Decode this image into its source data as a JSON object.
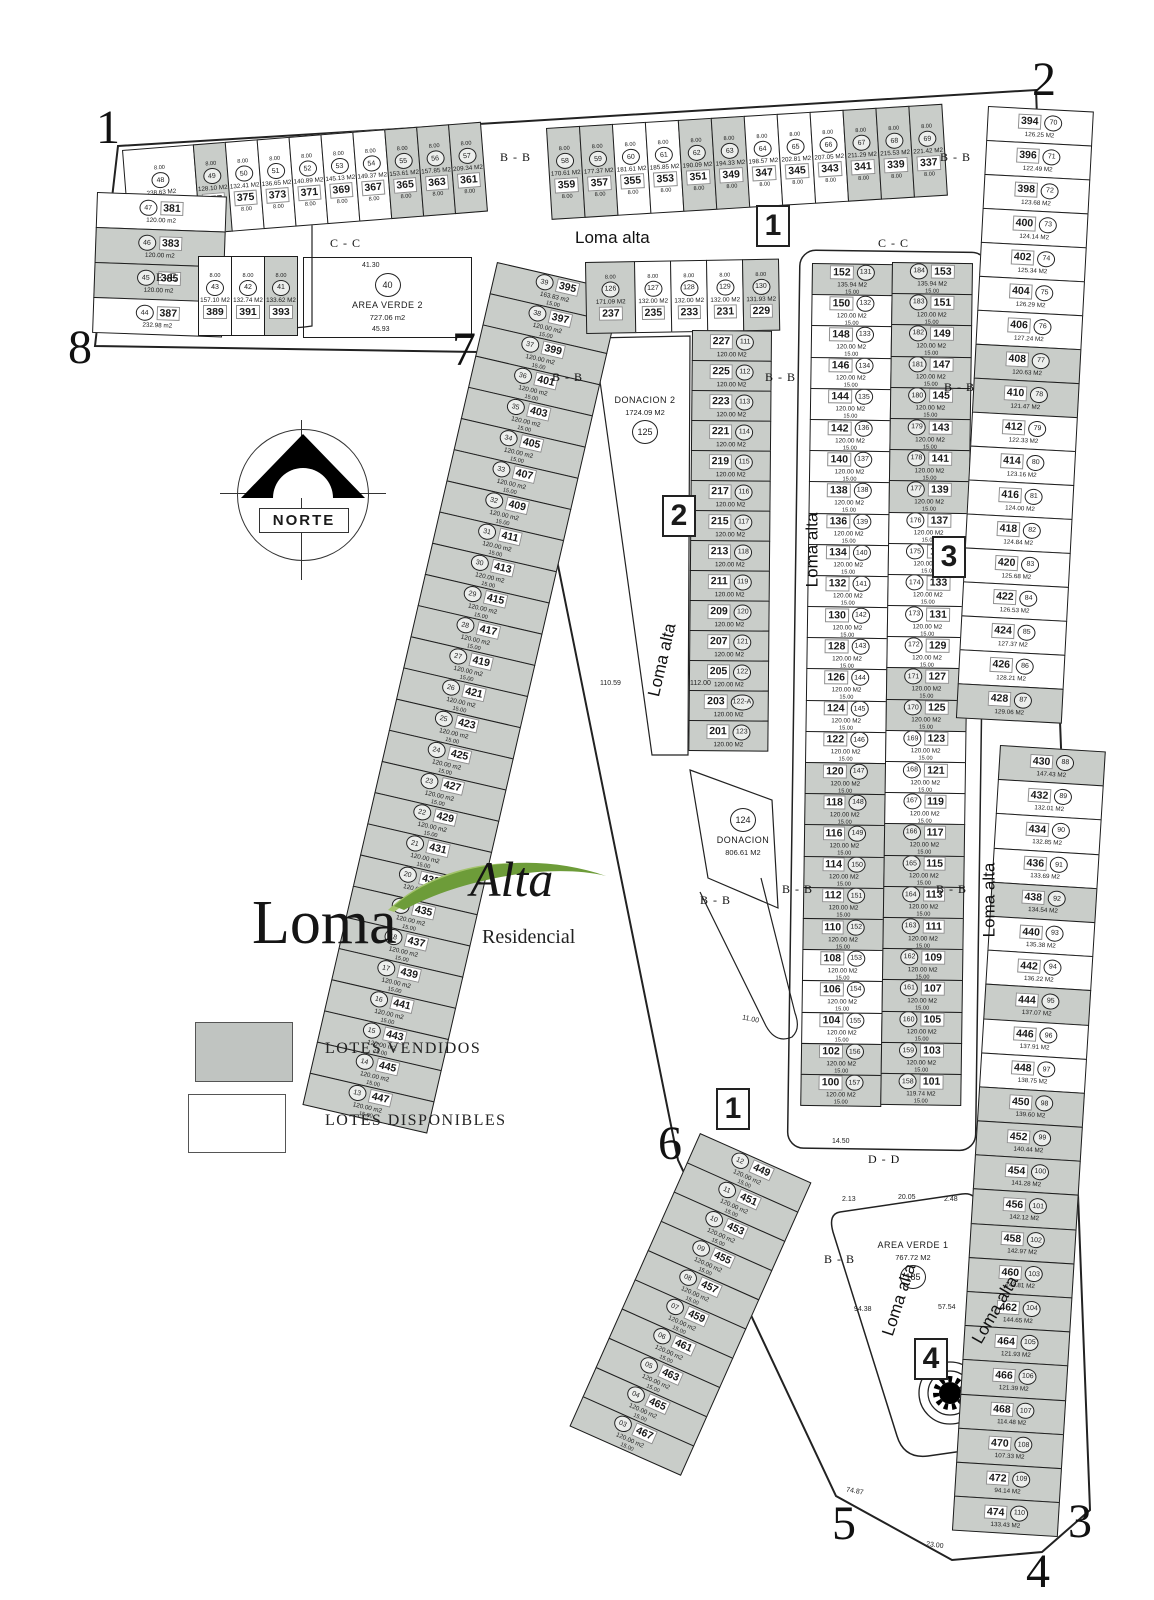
{
  "legend": {
    "sold_label": "LOTES VENDIDOS",
    "available_label": "LOTES DISPONIBLES"
  },
  "logo": {
    "word_main": "Loma",
    "word_accent": "Alta",
    "word_sub": "Residencial"
  },
  "compass": {
    "label": "NORTE"
  },
  "streets": {
    "name": "Loma alta"
  },
  "sections": {
    "cc": "C - C",
    "bb": "B - B",
    "dd": "D - D",
    "ee": "E-E"
  },
  "corner_markers": [
    "1",
    "2",
    "3",
    "4",
    "5",
    "6",
    "7",
    "8"
  ],
  "route_markers": [
    "1",
    "2",
    "3",
    "1",
    "4"
  ],
  "green_areas": {
    "area_verde_2": {
      "name": "AREA VERDE 2",
      "area": "727.06 m2",
      "ref": "40"
    },
    "donacion_2": {
      "name": "DONACION 2",
      "area": "1724.09 M2",
      "ref": "125"
    },
    "donacion_1": {
      "name": "DONACION",
      "area": "806.61 M2",
      "ref": "124"
    },
    "area_verde_1": {
      "name": "AREA VERDE 1",
      "area": "767.72 M2",
      "ref": "185"
    }
  },
  "dimensions": [
    "41.30",
    "45.93",
    "110.59",
    "112.00",
    "11.00",
    "74.87",
    "23.00",
    "2.13",
    "20.05",
    "2.48",
    "94.38",
    "57.54",
    "14.50"
  ],
  "colors": {
    "sold_fill": "#c9cdc9",
    "line": "#1c1c1c",
    "logo_green_dark": "#6d9c39",
    "logo_green_light": "#a3c36b"
  },
  "blocks": {
    "top_left_row": [
      {
        "l": "379",
        "r": "48",
        "a": "238.63 M2",
        "s": false
      },
      {
        "l": "377",
        "r": "49",
        "a": "128.10 M2",
        "s": true
      },
      {
        "l": "375",
        "r": "50",
        "a": "132.41 M2",
        "s": false
      },
      {
        "l": "373",
        "r": "51",
        "a": "136.65 M2",
        "s": false
      },
      {
        "l": "371",
        "r": "52",
        "a": "140.89 M2",
        "s": false
      },
      {
        "l": "369",
        "r": "53",
        "a": "145.13 M2",
        "s": false
      },
      {
        "l": "367",
        "r": "54",
        "a": "149.37 M2",
        "s": false
      },
      {
        "l": "365",
        "r": "55",
        "a": "153.61 M2",
        "s": true
      },
      {
        "l": "363",
        "r": "56",
        "a": "157.85 M2",
        "s": true
      },
      {
        "l": "361",
        "r": "57",
        "a": "209.34 M2",
        "s": true
      }
    ],
    "top_right_row": [
      {
        "l": "359",
        "r": "58",
        "a": "170.61 M2",
        "s": true
      },
      {
        "l": "357",
        "r": "59",
        "a": "177.37 M2",
        "s": true
      },
      {
        "l": "355",
        "r": "60",
        "a": "181.61 M2",
        "s": false
      },
      {
        "l": "353",
        "r": "61",
        "a": "185.85 M2",
        "s": false
      },
      {
        "l": "351",
        "r": "62",
        "a": "190.09 M2",
        "s": true
      },
      {
        "l": "349",
        "r": "63",
        "a": "194.33 M2",
        "s": true
      },
      {
        "l": "347",
        "r": "64",
        "a": "198.57 M2",
        "s": false
      },
      {
        "l": "345",
        "r": "65",
        "a": "202.81 M2",
        "s": false
      },
      {
        "l": "343",
        "r": "66",
        "a": "207.05 M2",
        "s": false
      },
      {
        "l": "341",
        "r": "67",
        "a": "211.29 M2",
        "s": true
      },
      {
        "l": "339",
        "r": "68",
        "a": "215.53 M2",
        "s": true
      },
      {
        "l": "337",
        "r": "69",
        "a": "221.42 M2",
        "s": true
      }
    ],
    "left_edge": [
      {
        "l": "381",
        "r": "47",
        "a": "120.00 m2",
        "s": false
      },
      {
        "l": "383",
        "r": "46",
        "a": "120.00 m2",
        "s": true
      },
      {
        "l": "385",
        "r": "45",
        "a": "120.00 m2",
        "s": true
      },
      {
        "l": "387",
        "r": "44",
        "a": "232.98 m2",
        "s": false
      }
    ],
    "row2": [
      {
        "l": "389",
        "r": "43",
        "a": "157.10 M2",
        "s": false
      },
      {
        "l": "391",
        "r": "42",
        "a": "132.74 M2",
        "s": false
      },
      {
        "l": "393",
        "r": "41",
        "a": "133.62 M2",
        "s": true
      }
    ],
    "west_diag_a": [
      {
        "l": "395",
        "r": "39",
        "a": "163.83 m2",
        "s": true
      },
      {
        "l": "397",
        "r": "38",
        "a": "120.00 m2",
        "s": true
      },
      {
        "l": "399",
        "r": "37",
        "a": "120.00 m2",
        "s": true
      },
      {
        "l": "401",
        "r": "36",
        "a": "120.00 m2",
        "s": true
      },
      {
        "l": "403",
        "r": "35",
        "a": "120.00 m2",
        "s": true
      },
      {
        "l": "405",
        "r": "34",
        "a": "120.00 m2",
        "s": true
      },
      {
        "l": "407",
        "r": "33",
        "a": "120.00 m2",
        "s": true
      },
      {
        "l": "409",
        "r": "32",
        "a": "120.00 m2",
        "s": true
      },
      {
        "l": "411",
        "r": "31",
        "a": "120.00 m2",
        "s": true
      },
      {
        "l": "413",
        "r": "30",
        "a": "120.00 m2",
        "s": true
      },
      {
        "l": "415",
        "r": "29",
        "a": "120.00 m2",
        "s": true
      },
      {
        "l": "417",
        "r": "28",
        "a": "120.00 m2",
        "s": true
      },
      {
        "l": "419",
        "r": "27",
        "a": "120.00 m2",
        "s": true
      },
      {
        "l": "421",
        "r": "26",
        "a": "120.00 m2",
        "s": true
      },
      {
        "l": "423",
        "r": "25",
        "a": "120.00 m2",
        "s": true
      },
      {
        "l": "425",
        "r": "24",
        "a": "120.00 m2",
        "s": true
      },
      {
        "l": "427",
        "r": "23",
        "a": "120.00 m2",
        "s": true
      },
      {
        "l": "429",
        "r": "22",
        "a": "120.00 m2",
        "s": true
      },
      {
        "l": "431",
        "r": "21",
        "a": "120.00 m2",
        "s": true
      },
      {
        "l": "433",
        "r": "20",
        "a": "120.00 m2",
        "s": true
      },
      {
        "l": "435",
        "r": "19",
        "a": "120.00 m2",
        "s": true
      },
      {
        "l": "437",
        "r": "18",
        "a": "120.00 m2",
        "s": true
      },
      {
        "l": "439",
        "r": "17",
        "a": "120.00 m2",
        "s": true
      },
      {
        "l": "441",
        "r": "16",
        "a": "120.00 m2",
        "s": true
      },
      {
        "l": "443",
        "r": "15",
        "a": "120.00 m2",
        "s": true
      },
      {
        "l": "445",
        "r": "14",
        "a": "120.00 m2",
        "s": true
      },
      {
        "l": "447",
        "r": "13",
        "a": "120.00 m2",
        "s": true
      }
    ],
    "west_diag_b": [
      {
        "l": "449",
        "r": "12",
        "a": "120.00 m2",
        "s": true
      },
      {
        "l": "451",
        "r": "11",
        "a": "120.00 m2",
        "s": true
      },
      {
        "l": "453",
        "r": "10",
        "a": "120.00 m2",
        "s": true
      },
      {
        "l": "455",
        "r": "09",
        "a": "120.00 m2",
        "s": true
      },
      {
        "l": "457",
        "r": "08",
        "a": "120.00 m2",
        "s": true
      },
      {
        "l": "459",
        "r": "07",
        "a": "120.00 m2",
        "s": true
      },
      {
        "l": "461",
        "r": "06",
        "a": "120.00 m2",
        "s": true
      },
      {
        "l": "463",
        "r": "05",
        "a": "120.00 m2",
        "s": true
      },
      {
        "l": "465",
        "r": "04",
        "a": "120.00 m2",
        "s": true
      },
      {
        "l": "467",
        "r": "03",
        "a": "120.00 m2",
        "s": true
      }
    ],
    "center_top_row": [
      {
        "l": "237",
        "r": "126",
        "a": "171.09 M2",
        "s": true
      },
      {
        "l": "235",
        "r": "127",
        "a": "132.00 M2",
        "s": false
      },
      {
        "l": "233",
        "r": "128",
        "a": "132.00 M2",
        "s": false
      },
      {
        "l": "231",
        "r": "129",
        "a": "132.00 M2",
        "s": false
      },
      {
        "l": "229",
        "r": "130",
        "a": "131.93 M2",
        "s": true
      }
    ],
    "center_column": [
      {
        "l": "227",
        "r": "111",
        "a": "120.00 M2",
        "s": true
      },
      {
        "l": "225",
        "r": "112",
        "a": "120.00 M2",
        "s": true
      },
      {
        "l": "223",
        "r": "113",
        "a": "120.00 M2",
        "s": true
      },
      {
        "l": "221",
        "r": "114",
        "a": "120.00 M2",
        "s": true
      },
      {
        "l": "219",
        "r": "115",
        "a": "120.00 M2",
        "s": true
      },
      {
        "l": "217",
        "r": "116",
        "a": "120.00 M2",
        "s": true
      },
      {
        "l": "215",
        "r": "117",
        "a": "120.00 M2",
        "s": true
      },
      {
        "l": "213",
        "r": "118",
        "a": "120.00 M2",
        "s": true
      },
      {
        "l": "211",
        "r": "119",
        "a": "120.00 M2",
        "s": true
      },
      {
        "l": "209",
        "r": "120",
        "a": "120.00 M2",
        "s": true
      },
      {
        "l": "207",
        "r": "121",
        "a": "120.00 M2",
        "s": true
      },
      {
        "l": "205",
        "r": "122",
        "a": "120.00 M2",
        "s": true
      },
      {
        "l": "203",
        "r": "122-A",
        "a": "120.00 M2",
        "s": true
      },
      {
        "l": "201",
        "r": "123",
        "a": "120.00 M2",
        "s": true
      }
    ],
    "mid_left": [
      {
        "l": "152",
        "r": "131",
        "a": "135.94 M2",
        "s": true
      },
      {
        "l": "150",
        "r": "132",
        "a": "120.00 M2",
        "s": false
      },
      {
        "l": "148",
        "r": "133",
        "a": "120.00 M2",
        "s": false
      },
      {
        "l": "146",
        "r": "134",
        "a": "120.00 M2",
        "s": false
      },
      {
        "l": "144",
        "r": "135",
        "a": "120.00 M2",
        "s": false
      },
      {
        "l": "142",
        "r": "136",
        "a": "120.00 M2",
        "s": false
      },
      {
        "l": "140",
        "r": "137",
        "a": "120.00 M2",
        "s": false
      },
      {
        "l": "138",
        "r": "138",
        "a": "120.00 M2",
        "s": false
      },
      {
        "l": "136",
        "r": "139",
        "a": "120.00 M2",
        "s": false
      },
      {
        "l": "134",
        "r": "140",
        "a": "120.00 M2",
        "s": false
      },
      {
        "l": "132",
        "r": "141",
        "a": "120.00 M2",
        "s": false
      },
      {
        "l": "130",
        "r": "142",
        "a": "120.00 M2",
        "s": false
      },
      {
        "l": "128",
        "r": "143",
        "a": "120.00 M2",
        "s": false
      },
      {
        "l": "126",
        "r": "144",
        "a": "120.00 M2",
        "s": false
      },
      {
        "l": "124",
        "r": "145",
        "a": "120.00 M2",
        "s": false
      },
      {
        "l": "122",
        "r": "146",
        "a": "120.00 M2",
        "s": false
      },
      {
        "l": "120",
        "r": "147",
        "a": "120.00 M2",
        "s": true
      },
      {
        "l": "118",
        "r": "148",
        "a": "120.00 M2",
        "s": true
      },
      {
        "l": "116",
        "r": "149",
        "a": "120.00 M2",
        "s": true
      },
      {
        "l": "114",
        "r": "150",
        "a": "120.00 M2",
        "s": true
      },
      {
        "l": "112",
        "r": "151",
        "a": "120.00 M2",
        "s": true
      },
      {
        "l": "110",
        "r": "152",
        "a": "120.00 M2",
        "s": true
      },
      {
        "l": "108",
        "r": "153",
        "a": "120.00 M2",
        "s": false
      },
      {
        "l": "106",
        "r": "154",
        "a": "120.00 M2",
        "s": false
      },
      {
        "l": "104",
        "r": "155",
        "a": "120.00 M2",
        "s": false
      },
      {
        "l": "102",
        "r": "156",
        "a": "120.00 M2",
        "s": true
      },
      {
        "l": "100",
        "r": "157",
        "a": "120.00 M2",
        "s": true
      }
    ],
    "mid_right": [
      {
        "l": "153",
        "r": "184",
        "a": "135.94 M2",
        "s": true
      },
      {
        "l": "151",
        "r": "183",
        "a": "120.00 M2",
        "s": true
      },
      {
        "l": "149",
        "r": "182",
        "a": "120.00 M2",
        "s": true
      },
      {
        "l": "147",
        "r": "181",
        "a": "120.00 M2",
        "s": true
      },
      {
        "l": "145",
        "r": "180",
        "a": "120.00 M2",
        "s": true
      },
      {
        "l": "143",
        "r": "179",
        "a": "120.00 M2",
        "s": true
      },
      {
        "l": "141",
        "r": "178",
        "a": "120.00 M2",
        "s": true
      },
      {
        "l": "139",
        "r": "177",
        "a": "120.00 M2",
        "s": true
      },
      {
        "l": "137",
        "r": "176",
        "a": "120.00 M2",
        "s": false
      },
      {
        "l": "135",
        "r": "175",
        "a": "120.00 M2",
        "s": false
      },
      {
        "l": "133",
        "r": "174",
        "a": "120.00 M2",
        "s": false
      },
      {
        "l": "131",
        "r": "173",
        "a": "120.00 M2",
        "s": false
      },
      {
        "l": "129",
        "r": "172",
        "a": "120.00 M2",
        "s": false
      },
      {
        "l": "127",
        "r": "171",
        "a": "120.00 M2",
        "s": true
      },
      {
        "l": "125",
        "r": "170",
        "a": "120.00 M2",
        "s": true
      },
      {
        "l": "123",
        "r": "169",
        "a": "120.00 M2",
        "s": false
      },
      {
        "l": "121",
        "r": "168",
        "a": "120.00 M2",
        "s": false
      },
      {
        "l": "119",
        "r": "167",
        "a": "120.00 M2",
        "s": false
      },
      {
        "l": "117",
        "r": "166",
        "a": "120.00 M2",
        "s": true
      },
      {
        "l": "115",
        "r": "165",
        "a": "120.00 M2",
        "s": true
      },
      {
        "l": "113",
        "r": "164",
        "a": "120.00 M2",
        "s": true
      },
      {
        "l": "111",
        "r": "163",
        "a": "120.00 M2",
        "s": true
      },
      {
        "l": "109",
        "r": "162",
        "a": "120.00 M2",
        "s": true
      },
      {
        "l": "107",
        "r": "161",
        "a": "120.00 M2",
        "s": true
      },
      {
        "l": "105",
        "r": "160",
        "a": "120.00 M2",
        "s": true
      },
      {
        "l": "103",
        "r": "159",
        "a": "120.00 M2",
        "s": true
      },
      {
        "l": "101",
        "r": "158",
        "a": "119.74 M2",
        "s": true
      }
    ],
    "east_a": [
      {
        "l": "394",
        "r": "70",
        "a": "126.25 M2",
        "s": false
      },
      {
        "l": "396",
        "r": "71",
        "a": "122.49 M2",
        "s": false
      },
      {
        "l": "398",
        "r": "72",
        "a": "123.68 M2",
        "s": false
      },
      {
        "l": "400",
        "r": "73",
        "a": "124.14 M2",
        "s": false
      },
      {
        "l": "402",
        "r": "74",
        "a": "125.34 M2",
        "s": false
      },
      {
        "l": "404",
        "r": "75",
        "a": "126.29 M2",
        "s": false
      },
      {
        "l": "406",
        "r": "76",
        "a": "127.24 M2",
        "s": false
      },
      {
        "l": "408",
        "r": "77",
        "a": "120.63 M2",
        "s": true
      },
      {
        "l": "410",
        "r": "78",
        "a": "121.47 M2",
        "s": true
      },
      {
        "l": "412",
        "r": "79",
        "a": "122.33 M2",
        "s": false
      },
      {
        "l": "414",
        "r": "80",
        "a": "123.16 M2",
        "s": false
      },
      {
        "l": "416",
        "r": "81",
        "a": "124.00 M2",
        "s": false
      },
      {
        "l": "418",
        "r": "82",
        "a": "124.84 M2",
        "s": false
      },
      {
        "l": "420",
        "r": "83",
        "a": "125.68 M2",
        "s": false
      },
      {
        "l": "422",
        "r": "84",
        "a": "126.53 M2",
        "s": false
      },
      {
        "l": "424",
        "r": "85",
        "a": "127.37 M2",
        "s": false
      },
      {
        "l": "426",
        "r": "86",
        "a": "128.21 M2",
        "s": false
      },
      {
        "l": "428",
        "r": "87",
        "a": "129.06 M2",
        "s": true
      }
    ],
    "east_b": [
      {
        "l": "430",
        "r": "88",
        "a": "147.43 M2",
        "s": true
      },
      {
        "l": "432",
        "r": "89",
        "a": "132.01 M2",
        "s": false
      },
      {
        "l": "434",
        "r": "90",
        "a": "132.85 M2",
        "s": false
      },
      {
        "l": "436",
        "r": "91",
        "a": "133.69 M2",
        "s": false
      },
      {
        "l": "438",
        "r": "92",
        "a": "134.54 M2",
        "s": true
      },
      {
        "l": "440",
        "r": "93",
        "a": "135.38 M2",
        "s": false
      },
      {
        "l": "442",
        "r": "94",
        "a": "136.22 M2",
        "s": false
      },
      {
        "l": "444",
        "r": "95",
        "a": "137.07 M2",
        "s": true
      },
      {
        "l": "446",
        "r": "96",
        "a": "137.91 M2",
        "s": false
      },
      {
        "l": "448",
        "r": "97",
        "a": "138.75 M2",
        "s": false
      },
      {
        "l": "450",
        "r": "98",
        "a": "139.60 M2",
        "s": true
      },
      {
        "l": "452",
        "r": "99",
        "a": "140.44 M2",
        "s": true
      },
      {
        "l": "454",
        "r": "100",
        "a": "141.28 M2",
        "s": true
      },
      {
        "l": "456",
        "r": "101",
        "a": "142.12 M2",
        "s": true
      },
      {
        "l": "458",
        "r": "102",
        "a": "142.97 M2",
        "s": true
      },
      {
        "l": "460",
        "r": "103",
        "a": "143.81 M2",
        "s": true
      },
      {
        "l": "462",
        "r": "104",
        "a": "144.65 M2",
        "s": true
      },
      {
        "l": "464",
        "r": "105",
        "a": "121.93 M2",
        "s": true
      },
      {
        "l": "466",
        "r": "106",
        "a": "121.39 M2",
        "s": true
      },
      {
        "l": "468",
        "r": "107",
        "a": "114.48 M2",
        "s": true
      },
      {
        "l": "470",
        "r": "108",
        "a": "107.33 M2",
        "s": true
      },
      {
        "l": "472",
        "r": "109",
        "a": "94.14 M2",
        "s": true
      },
      {
        "l": "474",
        "r": "110",
        "a": "133.43 M2",
        "s": true
      }
    ]
  }
}
